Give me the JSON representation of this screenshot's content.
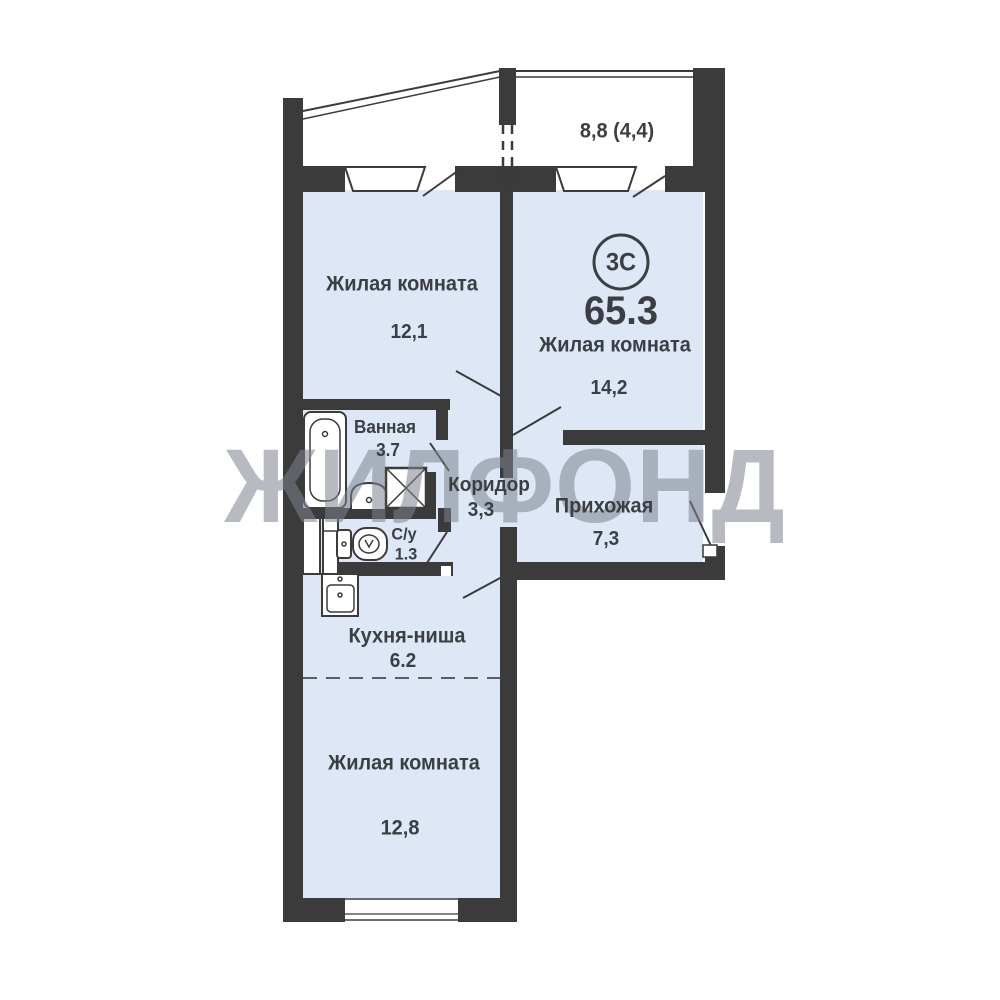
{
  "plan": {
    "badge": {
      "type_label": "3С",
      "total_area": "65.3"
    },
    "balcony": {
      "area_label": "8,8 (4,4)"
    },
    "rooms": {
      "living_top_left": {
        "name": "Жилая комната",
        "area": "12,1"
      },
      "living_top_right": {
        "name": "Жилая комната",
        "area": "14,2"
      },
      "bathroom": {
        "name": "Ванная",
        "area": "3.7"
      },
      "corridor": {
        "name": "Коридор",
        "area": "3,3"
      },
      "hallway": {
        "name": "Прихожая",
        "area": "7,3"
      },
      "wc": {
        "name": "С/у",
        "area": "1.3"
      },
      "kitchen_niche": {
        "name": "Кухня-ниша",
        "area": "6.2"
      },
      "living_bottom": {
        "name": "Жилая комната",
        "area": "12,8"
      }
    },
    "watermark": "ЖИЛФОНД",
    "colors": {
      "room_fill": "#dde7f5",
      "wall": "#3b3b3b",
      "text": "#3b3f44",
      "watermark": "#7d8490"
    }
  }
}
